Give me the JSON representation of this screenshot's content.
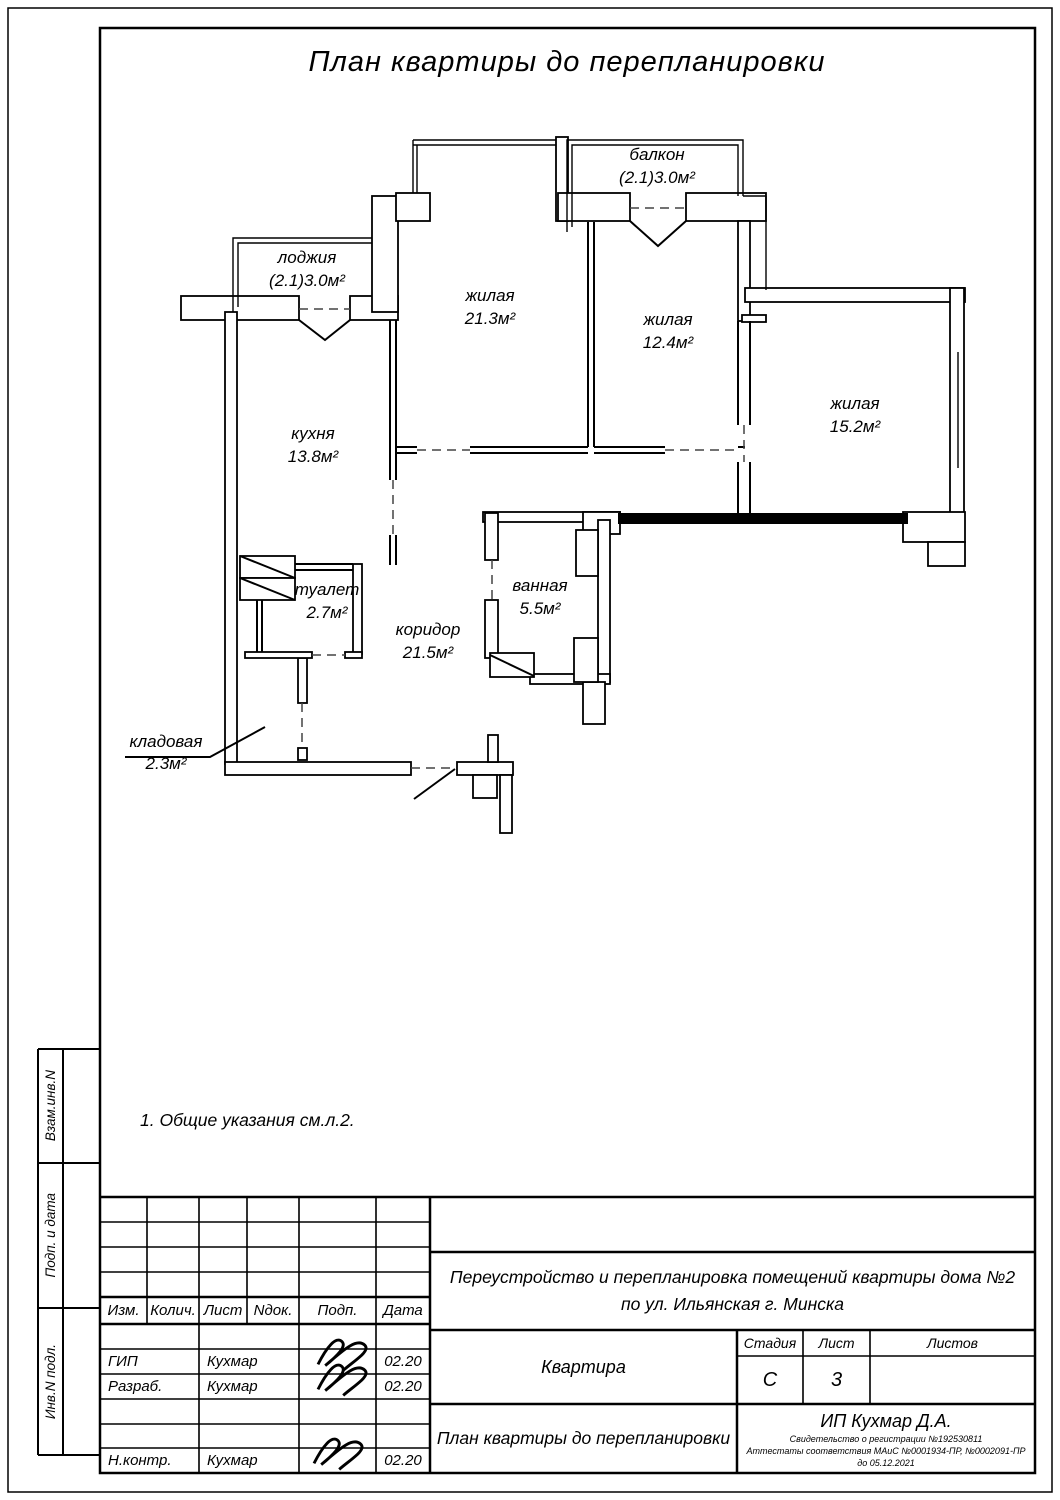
{
  "title": "План квартиры до перепланировки",
  "note": "1. Общие указания см.л.2.",
  "plan": {
    "rooms": [
      {
        "name": "балкон",
        "area": "(2.1)3.0м²"
      },
      {
        "name": "лоджия",
        "area": "(2.1)3.0м²"
      },
      {
        "name": "жилая",
        "area": "21.3м²"
      },
      {
        "name": "жилая",
        "area": "12.4м²"
      },
      {
        "name": "жилая",
        "area": "15.2м²"
      },
      {
        "name": "кухня",
        "area": "13.8м²"
      },
      {
        "name": "туалет",
        "area": "2.7м²"
      },
      {
        "name": "ванная",
        "area": "5.5м²"
      },
      {
        "name": "коридор",
        "area": "21.5м²"
      },
      {
        "name": "кладовая",
        "area": "2.3м²"
      }
    ]
  },
  "sidebar": {
    "labels": [
      "Взам.инв.N",
      "Подп. и дата",
      "Инв.N подл."
    ]
  },
  "titleblock": {
    "header_cols": [
      "Изм.",
      "Колич.",
      "Лист",
      "Nдок.",
      "Подп.",
      "Дата"
    ],
    "rows": [
      {
        "role": "ГИП",
        "name": "Кухмар",
        "date": "02.20"
      },
      {
        "role": "Разраб.",
        "name": "Кухмар",
        "date": "02.20"
      },
      {
        "role": "Н.контр.",
        "name": "Кухмар",
        "date": "02.20"
      }
    ],
    "project_line1": "Переустройство и перепланировка помещений квартиры дома  №2",
    "project_line2": "по ул. Ильянская г. Минска",
    "object_name": "Квартира",
    "stage_label": "Стадия",
    "sheet_label": "Лист",
    "sheets_label": "Листов",
    "stage": "С",
    "sheet": "3",
    "sheets": "",
    "drawing_title": "План квартиры до перепланировки",
    "company": "ИП Кухмар Д.А.",
    "cert1": "Свидетельство о регистрации №192530811",
    "cert2": "Аттестаты соответствия МАиС №0001934-ПР, №0002091-ПР",
    "cert3": "до 05.12.2021"
  }
}
